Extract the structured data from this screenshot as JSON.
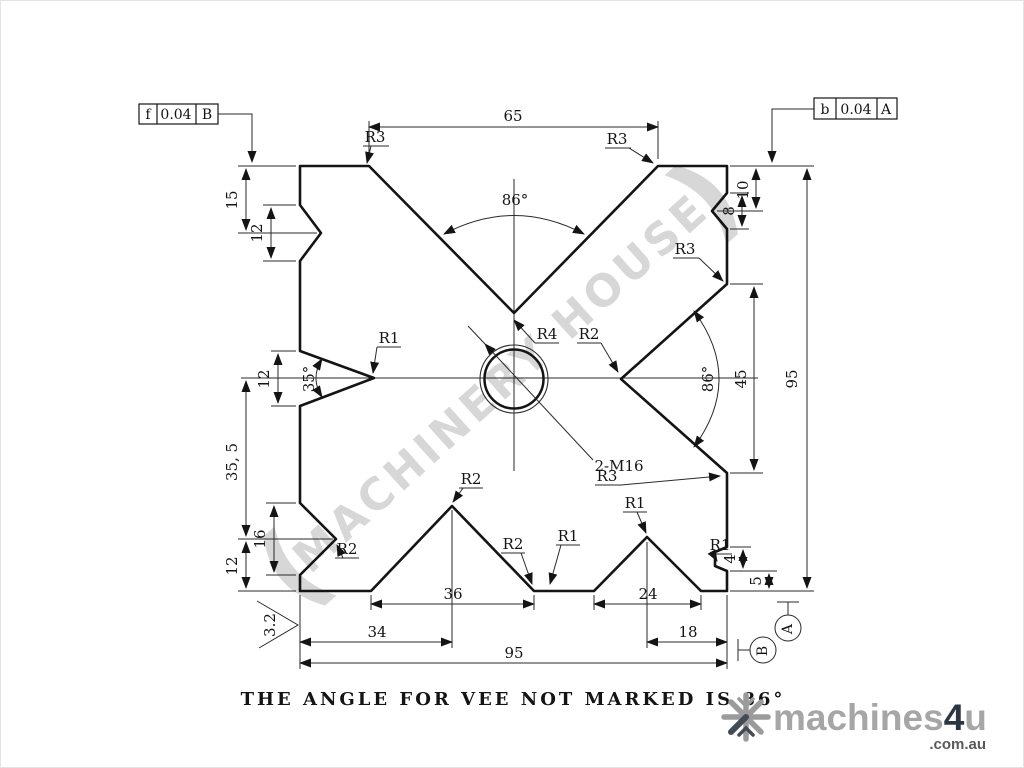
{
  "drawing": {
    "note": "THE ANGLE FOR VEE NOT MARKED IS 86°",
    "watermark": {
      "open": "(",
      "text": "MACHINERY HOUSE",
      "close": ")"
    },
    "tolerance_frames": {
      "left": {
        "symbol": "f",
        "value": "0.04",
        "datum": "B"
      },
      "right": {
        "symbol": "b",
        "value": "0.04",
        "datum": "A"
      }
    },
    "datums": {
      "a": "A",
      "b": "B"
    },
    "surface_finish": "3.2",
    "thread_callout": "2-M16",
    "angles": {
      "top_vee": "86°",
      "right_vee": "86°",
      "left_notch": "35°"
    },
    "dims": {
      "top_vee_width": "65",
      "overall_height": "95",
      "overall_width": "95",
      "right_top_offset": "10",
      "right_notch_height": "8",
      "right_vee_opening": "45",
      "left_top_offset": "15",
      "left_top_notch": "12",
      "left_mid_notch": "12",
      "left_lower_span": "35, 5",
      "left_lower_notch": "16",
      "left_bottom_offset": "12",
      "vee1_width": "36",
      "vee2_width": "24",
      "vee1_center_offset": "34",
      "vee2_center_offset": "18",
      "corner_notch_height": "4",
      "corner_notch_offset": "5"
    },
    "radii": {
      "top_left": "R3",
      "top_right": "R3",
      "right_upper": "R3",
      "right_lower": "R3",
      "left_notch_tip": "R1",
      "top_vee_tip": "R4",
      "right_vee_tip": "R2",
      "lower_left_notch": "R2",
      "vee1_tip": "R2",
      "vee1_corner": "R2",
      "bottom_mid": "R1",
      "vee2_tip": "R1",
      "corner_notch": "R1"
    }
  },
  "logo": {
    "name": "machines",
    "accent": "4",
    "suffix": "u",
    "domain": ".com.au"
  }
}
